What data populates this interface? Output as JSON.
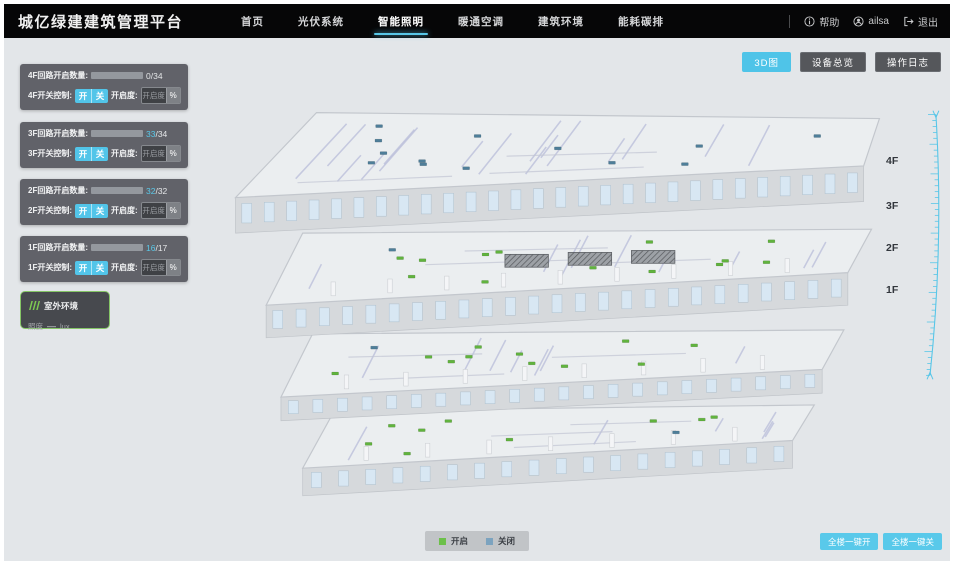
{
  "header": {
    "title": "城亿绿建建筑管理平台",
    "nav": [
      {
        "label": "首页",
        "active": false
      },
      {
        "label": "光伏系统",
        "active": false
      },
      {
        "label": "智能照明",
        "active": true
      },
      {
        "label": "暖通空调",
        "active": false
      },
      {
        "label": "建筑环境",
        "active": false
      },
      {
        "label": "能耗碳排",
        "active": false
      }
    ],
    "help_label": "帮助",
    "user_name": "ailsa",
    "logout_label": "退出"
  },
  "view_buttons": [
    {
      "label": "3D图",
      "active": true
    },
    {
      "label": "设备总览",
      "active": false
    },
    {
      "label": "操作日志",
      "active": false
    }
  ],
  "floor_panels": [
    {
      "floor": "4F",
      "circuit_label": "4F回路开启数量:",
      "on": 0,
      "total": 34,
      "value_on": "0",
      "value_total": "/34",
      "switch_label": "4F开关控制:",
      "on_btn": "开",
      "off_btn": "关",
      "dim_label": "开启度:",
      "dim_placeholder": "开启度",
      "percent": "%"
    },
    {
      "floor": "3F",
      "circuit_label": "3F回路开启数量:",
      "on": 33,
      "total": 34,
      "value_on": "33",
      "value_total": "/34",
      "switch_label": "3F开关控制:",
      "on_btn": "开",
      "off_btn": "关",
      "dim_label": "开启度:",
      "dim_placeholder": "开启度",
      "percent": "%"
    },
    {
      "floor": "2F",
      "circuit_label": "2F回路开启数量:",
      "on": 32,
      "total": 32,
      "value_on": "32",
      "value_total": "/32",
      "switch_label": "2F开关控制:",
      "on_btn": "开",
      "off_btn": "关",
      "dim_label": "开启度:",
      "dim_placeholder": "开启度",
      "percent": "%"
    },
    {
      "floor": "1F",
      "circuit_label": "1F回路开启数量:",
      "on": 16,
      "total": 17,
      "value_on": "16",
      "value_total": "/17",
      "switch_label": "1F开关控制:",
      "on_btn": "开",
      "off_btn": "关",
      "dim_label": "开启度:",
      "dim_placeholder": "开启度",
      "percent": "%"
    }
  ],
  "outdoor": {
    "title": "室外环境",
    "metric_label": "照度",
    "value": "—",
    "unit": "lux"
  },
  "floor_labels": [
    "4F",
    "3F",
    "2F",
    "1F"
  ],
  "legend": {
    "on_label": "开启",
    "off_label": "关闭"
  },
  "bulk_buttons": [
    {
      "label": "全楼一键开"
    },
    {
      "label": "全楼一键关"
    }
  ],
  "colors": {
    "accent": "#4fc4e8",
    "marker_on": "#61b33e",
    "marker_off": "#4e7e99",
    "legend_on": "#6cc04a",
    "legend_off": "#7ca3bf"
  },
  "building": {
    "floors": [
      {
        "name": "4F",
        "on_markers": 0,
        "off_markers": 13
      },
      {
        "name": "3F",
        "on_markers": 13,
        "off_markers": 1
      },
      {
        "name": "2F",
        "on_markers": 11,
        "off_markers": 1
      },
      {
        "name": "1F",
        "on_markers": 9,
        "off_markers": 1
      }
    ]
  }
}
